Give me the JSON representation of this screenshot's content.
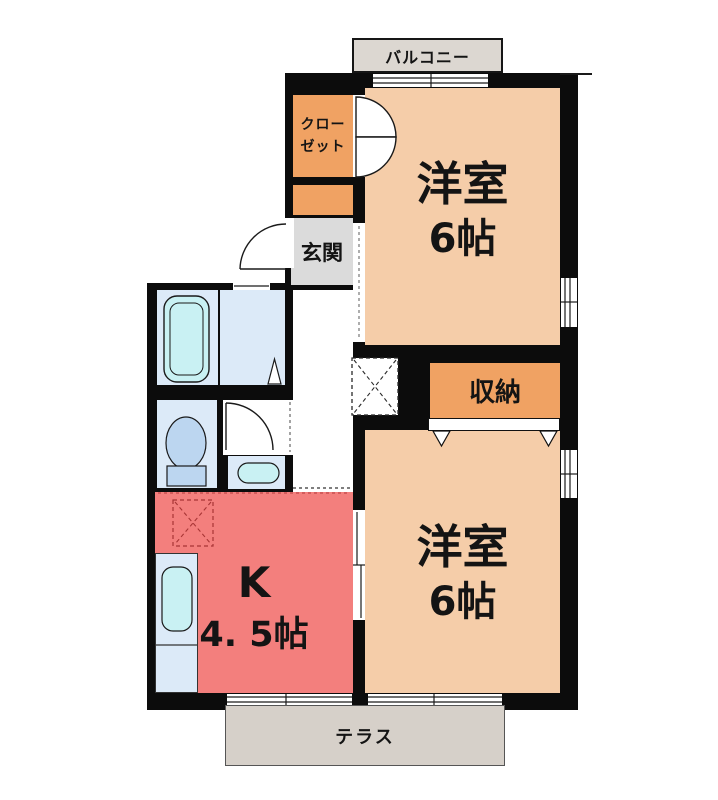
{
  "plan_type": "floor-plan",
  "rooms": {
    "balcony": {
      "label": "バルコニー"
    },
    "closet": {
      "line1": "クロー",
      "line2": "ゼット"
    },
    "entrance": {
      "label": "玄関"
    },
    "western_room_top": {
      "name": "洋室",
      "size": "6帖"
    },
    "storage": {
      "label": "収納"
    },
    "western_room_bottom": {
      "name": "洋室",
      "size": "6帖"
    },
    "kitchen": {
      "name": "K",
      "size": "4. 5帖"
    },
    "terrace": {
      "label": "テラス"
    }
  },
  "colors": {
    "wall": "#0c0c0c",
    "western_room": "#f5cda9",
    "closet_storage": "#f0a263",
    "kitchen": "#f37f7d",
    "wet_area": "#dceaf8",
    "fixture": "#c9f1f3",
    "toilet_fixture": "#bcd6f0",
    "entrance_floor": "#dbdbdb",
    "balcony": "#dcd7d1",
    "terrace": "#d6d0c9"
  }
}
